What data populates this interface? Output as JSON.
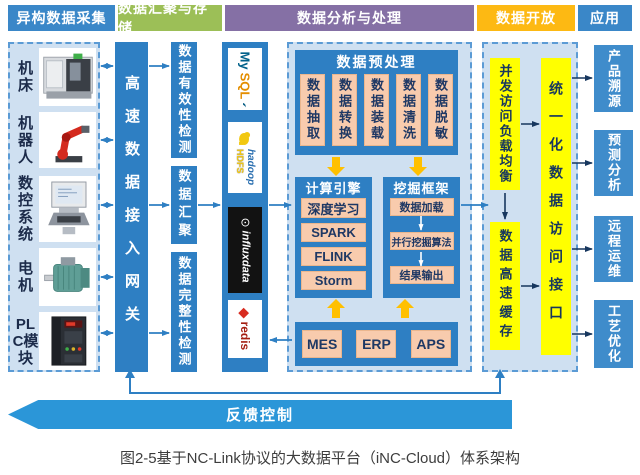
{
  "headers": [
    "异构数据采集",
    "数据汇聚与存储",
    "数据分析与处理",
    "数据开放",
    "应用"
  ],
  "acquisition": {
    "devices": [
      {
        "label": "机床",
        "icon": "machine-tool"
      },
      {
        "label": "机器人",
        "icon": "robot-arm"
      },
      {
        "label": "数控系统",
        "icon": "cnc-system"
      },
      {
        "label": "电机",
        "icon": "motor"
      },
      {
        "label": "PLC模块",
        "icon": "plc-module"
      }
    ],
    "gateway_label": "高速数据接入网关"
  },
  "storage": {
    "validity": "数据有效性检测",
    "aggregate": "数据汇聚",
    "integrity": "数据完整性检测",
    "databases": {
      "mysql_part1": "My",
      "mysql_part2": "SQL",
      "hadoop": "hadoop",
      "hadoop_sub": "HDFS",
      "influx": "influxdata",
      "redis": "redis"
    }
  },
  "analysis": {
    "preprocess_title": "数据预处理",
    "preprocess_steps": [
      "数据抽取",
      "数据转换",
      "数据装载",
      "数据清洗",
      "数据脱敏"
    ],
    "engine_title": "计算引擎",
    "engine_items": [
      "深度学习",
      "SPARK",
      "FLINK",
      "Storm"
    ],
    "mining_title": "挖掘框架",
    "mining_items": [
      "数据加载",
      "并行挖掘算法",
      "结果输出"
    ],
    "systems": [
      "MES",
      "ERP",
      "APS"
    ]
  },
  "open_section": {
    "load_balancer": "并发访问负载均衡",
    "cache": "数据高速缓存",
    "unified_api": "统一化数据访问接口"
  },
  "applications": [
    "产品溯源",
    "预测分析",
    "远程运维",
    "工艺优化"
  ],
  "feedback_label": "反馈控制",
  "caption": "图2-5基于NC-Link协议的大数据平台（iNC-Cloud）体系架构",
  "colors": {
    "primary_blue": "#2e7fc3",
    "header_blue": "#3a87c8",
    "header_green": "#9cbf57",
    "header_purple": "#8570a5",
    "header_amber": "#fdb913",
    "panel_light_blue": "#cfe0f1",
    "highlight_yellow": "#ffff00",
    "peach": "#f8cbad",
    "navy_text": "#1f3864",
    "arrow_yellow": "#ffc000",
    "feedback_blue": "#2b96d8"
  }
}
